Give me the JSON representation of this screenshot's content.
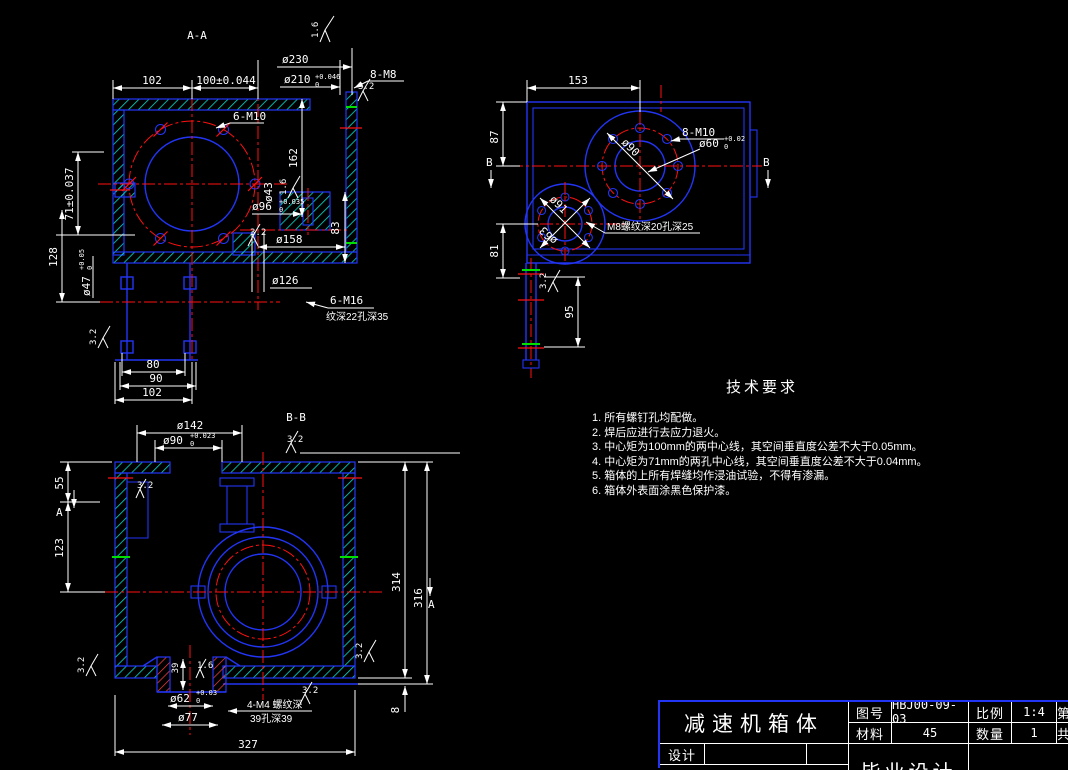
{
  "colors": {
    "background": "#000000",
    "line_blue": "#2235f5",
    "centerline_red": "#ff1111",
    "dimension_white": "#ffffff",
    "hatch_cyan": "#00ddcc",
    "tick_green": "#00e000"
  },
  "views": {
    "aa": {
      "label": "A-A",
      "dims": {
        "top102": "102",
        "top100": "100±0.044",
        "d230": "ø230",
        "d210": "ø210",
        "d210sup": "+0.046",
        "d210sub": "0",
        "m8": "8-M8",
        "m10": "6-M10",
        "h162": "162",
        "d43": "ø43",
        "d96": "ø96",
        "d96sup": "+0.035",
        "d96sub": "0",
        "h83": "83",
        "d158": "ø158",
        "d126": "ø126",
        "m16": "6-M16",
        "m16note": "纹深22孔深35",
        "v71": "71±0.037",
        "v128": "128",
        "d47": "ø47",
        "d47sup": "+0.05",
        "d47sub": "0",
        "b80": "80",
        "b90": "90",
        "b102": "102",
        "ra16": "1.6",
        "ra32": "3.2"
      }
    },
    "top": {
      "dims": {
        "w153": "153",
        "h87": "87",
        "h81": "81",
        "h95": "95",
        "secB": "B",
        "m10": "8-M10",
        "d60": "ø60",
        "d60sup": "+0.02",
        "d60sub": "0",
        "d90": "ø90",
        "d91": "ø91",
        "d63": "ø63",
        "m8note": "M8螺纹深20孔深25",
        "ra32": "3.2"
      }
    },
    "bb": {
      "label": "B-B",
      "dims": {
        "d142": "ø142",
        "d90": "ø90",
        "d90sup": "+0.023",
        "d90sub": "0",
        "v55": "55",
        "v123": "123",
        "secA": "A",
        "v314": "314",
        "v316": "316",
        "v8": "8",
        "v39": "39",
        "d62": "ø62",
        "d62sup": "+0.03",
        "d62sub": "0",
        "d77": "ø77",
        "w327": "327",
        "m4": "4-M4 螺纹深",
        "m4note": "39孔深39",
        "ra32": "3.2",
        "ra16": "1.6"
      }
    }
  },
  "tech": {
    "title": "技术要求",
    "items": [
      "1.  所有螺钉孔均配做。",
      "2.  焊后应进行去应力退火。",
      "3.  中心矩为100mm的两中心线，其空间垂直度公差不大于0.05mm。",
      "4.  中心矩为71mm的两孔中心线，其空间垂直度公差不大于0.04mm。",
      "5.  箱体的上所有焊缝均作浸油试验，不得有渗漏。",
      "6.  箱体外表面涂黑色保护漆。"
    ]
  },
  "title_block": {
    "part_name": "减速机箱体",
    "drawing_no_label": "图号",
    "drawing_no": "HBJ00-09-03",
    "scale_label": "比例",
    "scale": "1:4",
    "sheet_label": "第",
    "material_label": "材料",
    "material": "45",
    "qty_label": "数量",
    "qty": "1",
    "total_label": "共",
    "design_label": "设计",
    "project": "毕业设计"
  }
}
